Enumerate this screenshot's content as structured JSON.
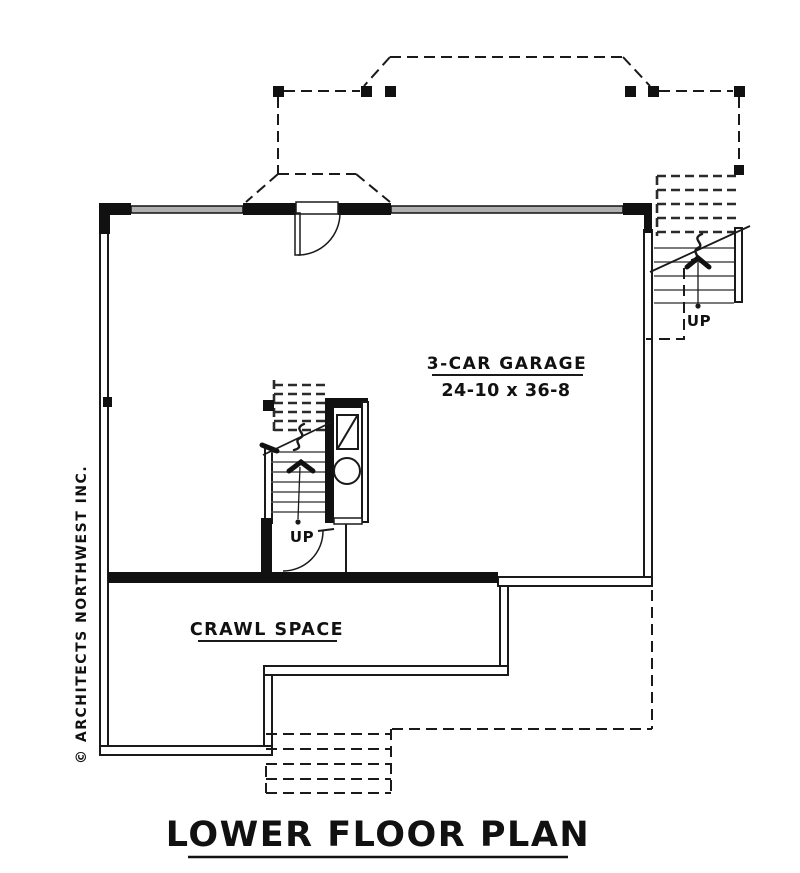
{
  "drawing": {
    "title": "LOWER FLOOR PLAN",
    "credit": "© ARCHITECTS NORTHWEST INC.",
    "rooms": {
      "garage": {
        "label": "3-CAR GARAGE",
        "dimensions": "24-10 x 36-8"
      },
      "crawl_space": {
        "label": "CRAWL SPACE"
      }
    },
    "stairs": {
      "interior": {
        "direction_label": "UP"
      },
      "exterior": {
        "direction_label": "UP"
      }
    },
    "colors": {
      "ink": "#1a1a1a",
      "tread_gray": "#4f4f4f",
      "header_gray": "#b0b0b0",
      "paper": "#ffffff"
    }
  }
}
